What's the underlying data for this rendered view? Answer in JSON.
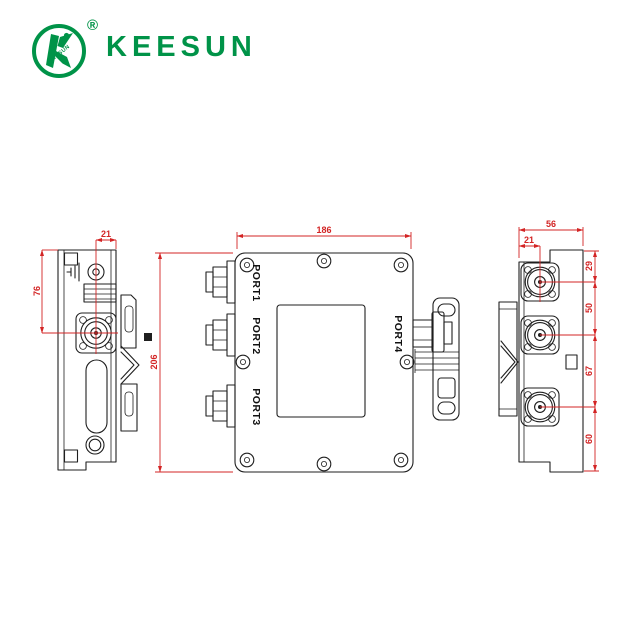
{
  "logo": {
    "brand": "KEESUN",
    "registered_mark": "®",
    "emblem_text": "KEESUN"
  },
  "colors": {
    "brand_green": "#009348",
    "dimension_red": "#d32424",
    "line_color": "#1f1f1f",
    "background": "#ffffff"
  },
  "drawing": {
    "left_view": {
      "dim_top_width": "21",
      "dim_side_height": "76"
    },
    "front_view": {
      "dim_width": "186",
      "dim_height": "206",
      "ports": [
        "PORT1",
        "PORT2",
        "PORT3",
        "PORT4"
      ]
    },
    "right_view": {
      "dim_total_width": "56",
      "dim_connector_offset": "21",
      "dim_spacings": [
        "29",
        "50",
        "67",
        "60"
      ]
    }
  }
}
